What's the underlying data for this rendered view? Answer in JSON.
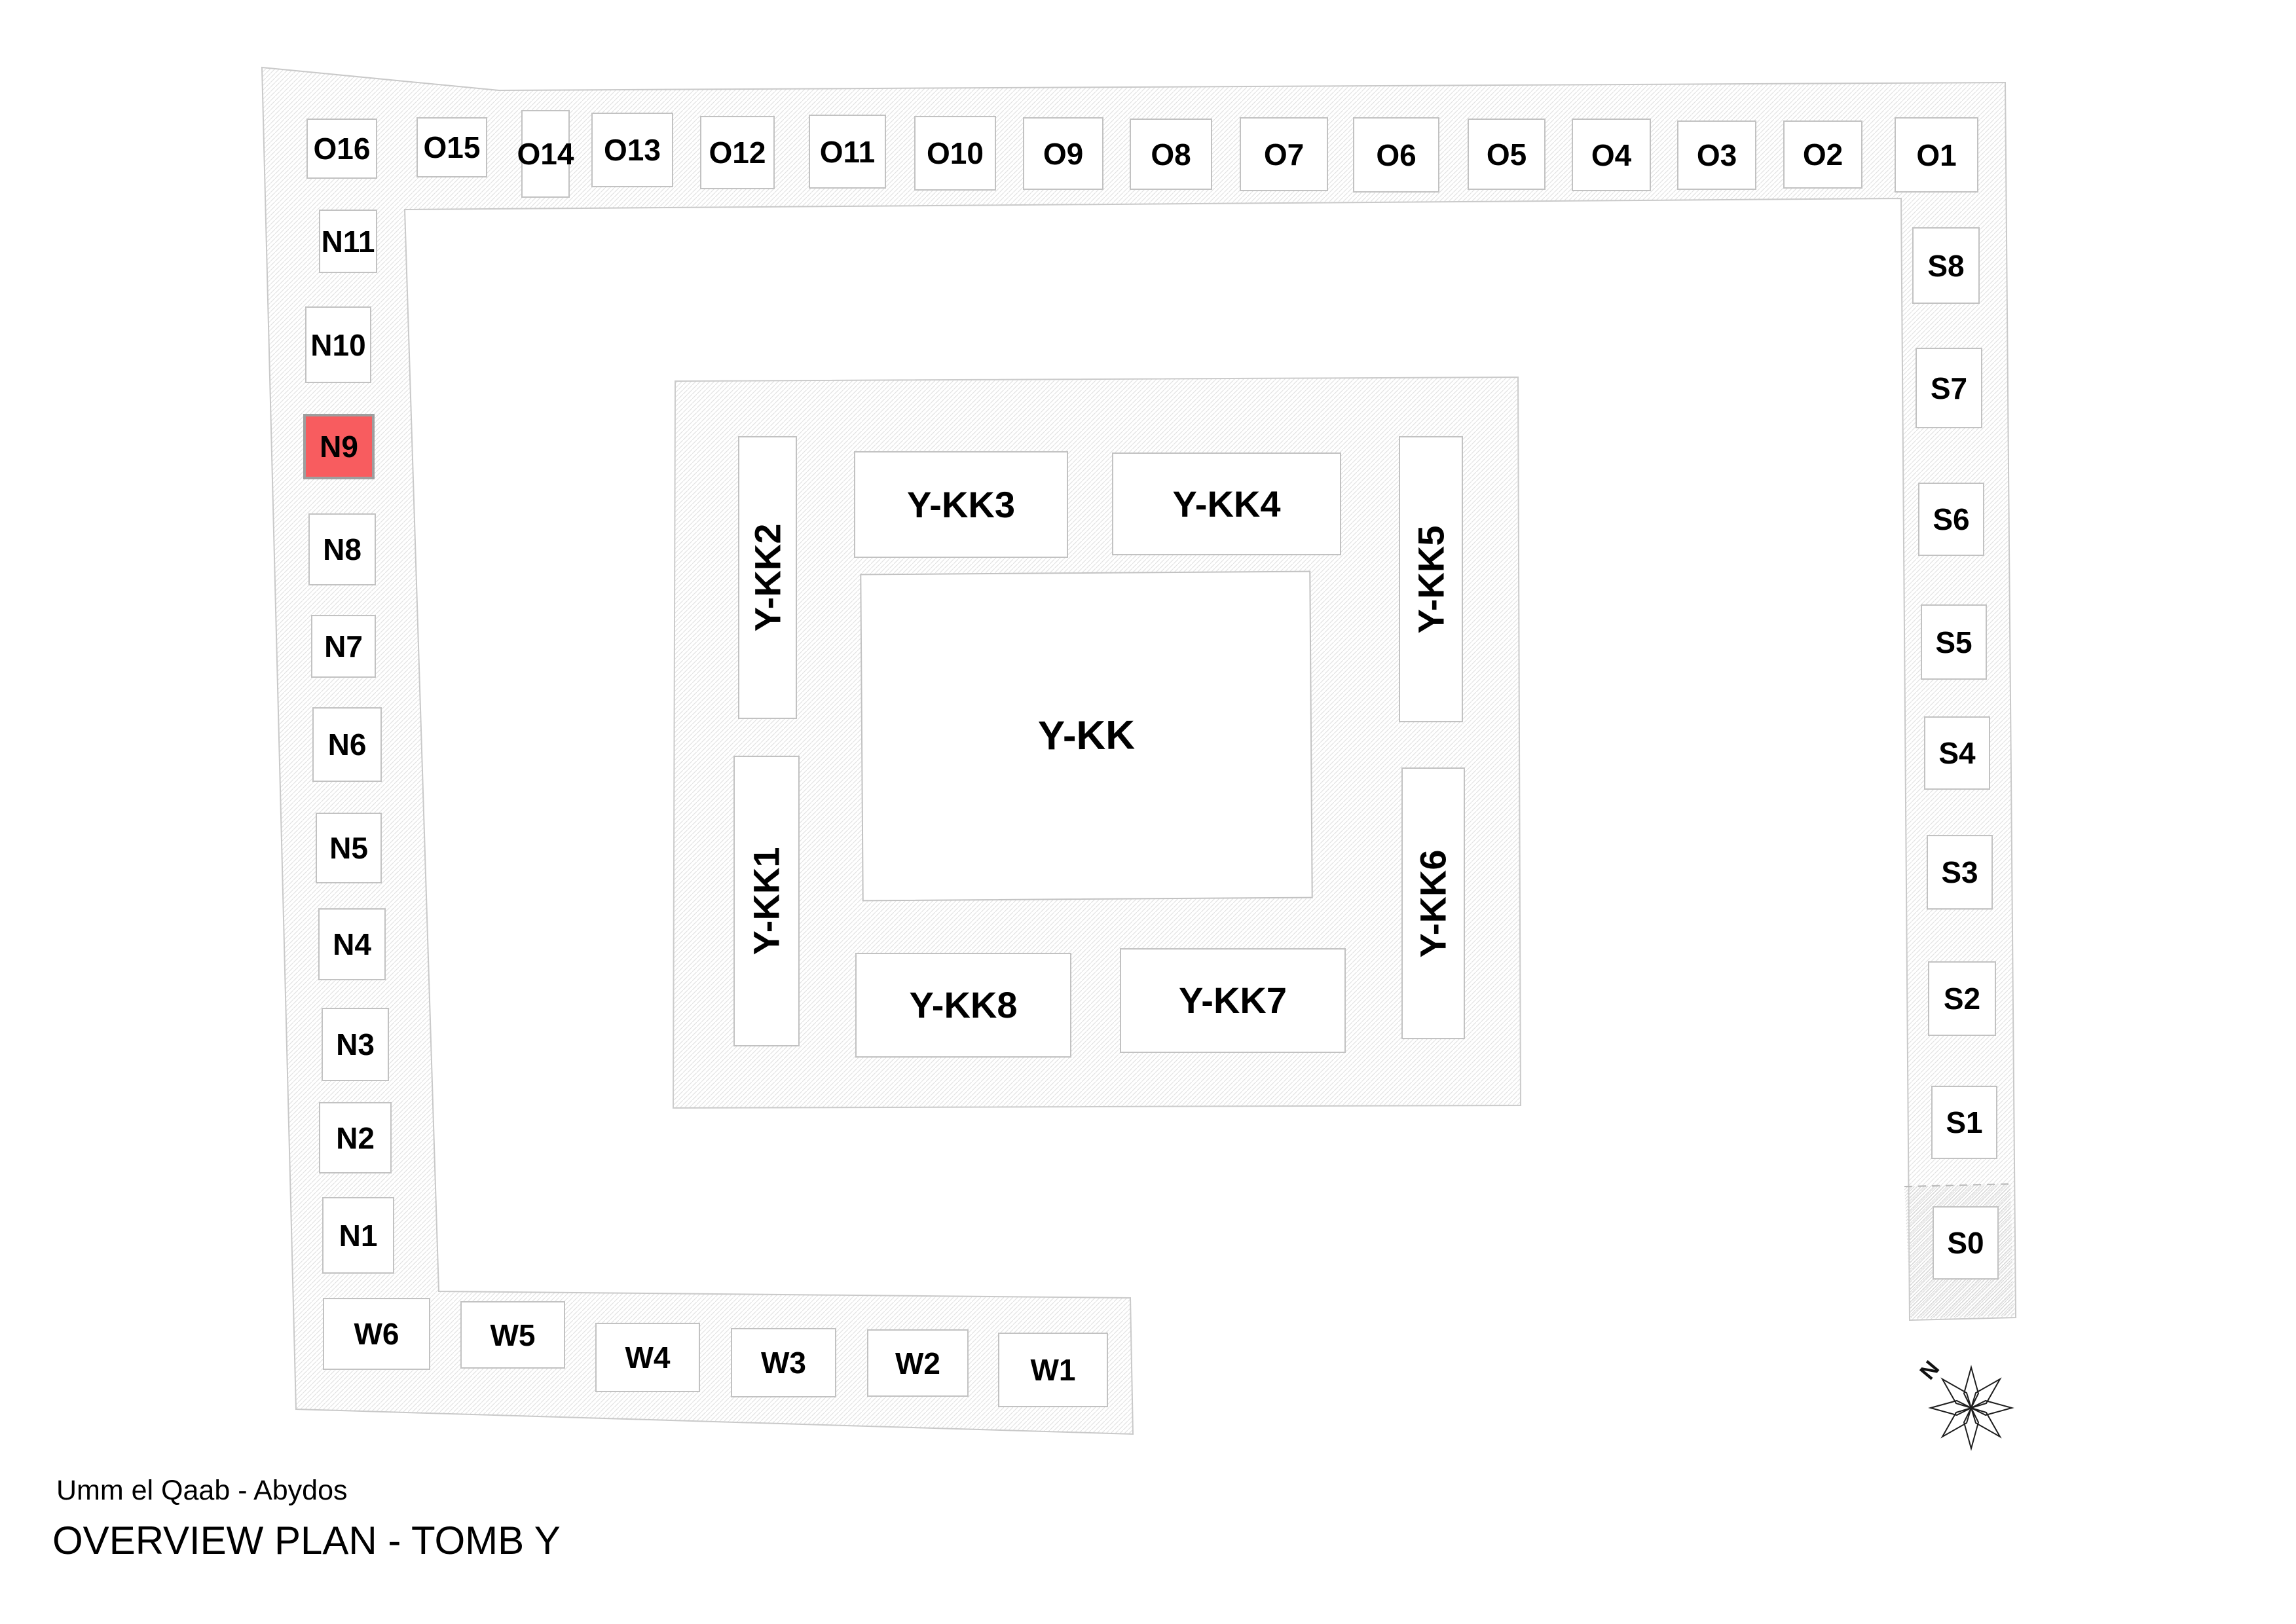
{
  "title_block": {
    "subtitle": "Umm el Qaab - Abydos",
    "title": "OVERVIEW PLAN - TOMB Y"
  },
  "compass": {
    "north_label": "N"
  },
  "colors": {
    "highlight_fill": "#f85c5f",
    "highlight_border": "#9e9e9e",
    "room_border": "#c2c2c2",
    "hatch_line": "#e3e3e3",
    "band_outline": "#c9c9c9",
    "text": "#000000"
  },
  "highlighted_room": "N9",
  "rooms": {
    "o_row": [
      "O16",
      "O15",
      "O14",
      "O13",
      "O12",
      "O11",
      "O10",
      "O9",
      "O8",
      "O7",
      "O6",
      "O5",
      "O4",
      "O3",
      "O2",
      "O1"
    ],
    "n_col": [
      "N11",
      "N10",
      "N9",
      "N8",
      "N7",
      "N6",
      "N5",
      "N4",
      "N3",
      "N2",
      "N1"
    ],
    "s_col": [
      "S8",
      "S7",
      "S6",
      "S5",
      "S4",
      "S3",
      "S2",
      "S1",
      "S0"
    ],
    "w_row": [
      "W6",
      "W5",
      "W4",
      "W3",
      "W2",
      "W1"
    ],
    "kk": {
      "center": "Y-KK",
      "left_upper": "Y-KK2",
      "left_lower": "Y-KK1",
      "top_left": "Y-KK3",
      "top_right": "Y-KK4",
      "right_upper": "Y-KK5",
      "right_lower": "Y-KK6",
      "bottom_left": "Y-KK8",
      "bottom_right": "Y-KK7"
    }
  }
}
